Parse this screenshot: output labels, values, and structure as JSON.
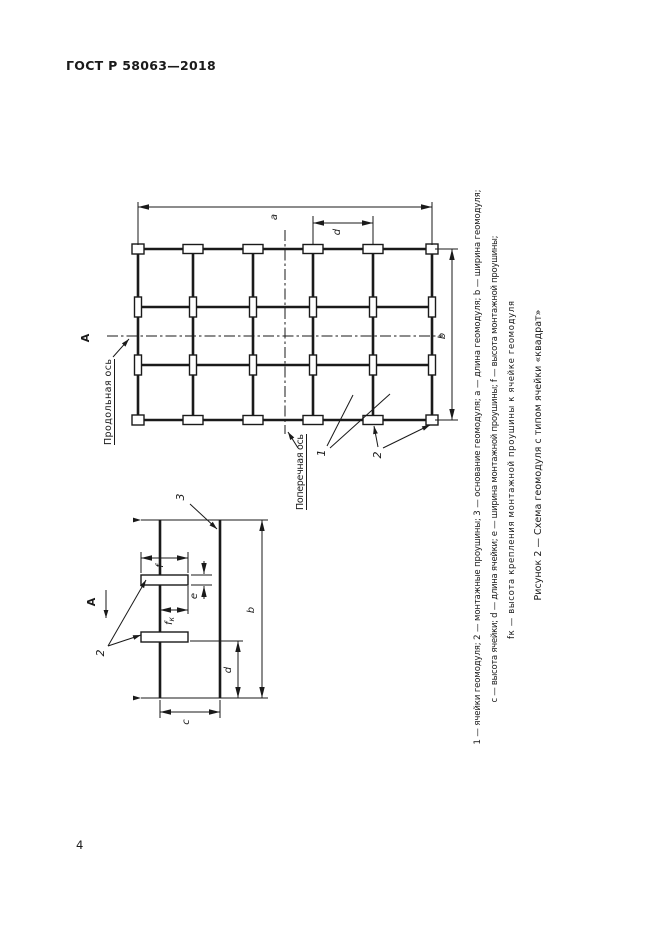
{
  "page": {
    "header": "ГОСТ Р 58063—2018",
    "page_number": "4"
  },
  "figure": {
    "caption": "Рисунок 2 — Схема геомодуля с типом ячейки «квадрат»",
    "footnote_lines": [
      "1 — ячейки геомодуля; 2 — монтажные проушины; 3 — основание геомодуля; a — длина геомодуля; b — ширина геомодуля;",
      "c — высота ячейки; d — длина ячейки; e — ширина монтажной проушины; f — высота монтажной проушины;",
      "fк — высота крепления монтажной проушины к ячейке геомодуля"
    ],
    "axis_labels": {
      "longitudinal": "Продольная ось",
      "transverse": "Поперечная ось"
    },
    "view_label": "A",
    "part_labels": {
      "cells": "1",
      "lugs": "2",
      "base": "3"
    },
    "dim_labels": {
      "a": "a",
      "b": "b",
      "c": "c",
      "d": "d",
      "e": "e",
      "f": "f",
      "fk_base": "f",
      "fk_sub": "к"
    }
  },
  "colors": {
    "ink": "#1a1a1a",
    "paper": "#ffffff"
  }
}
